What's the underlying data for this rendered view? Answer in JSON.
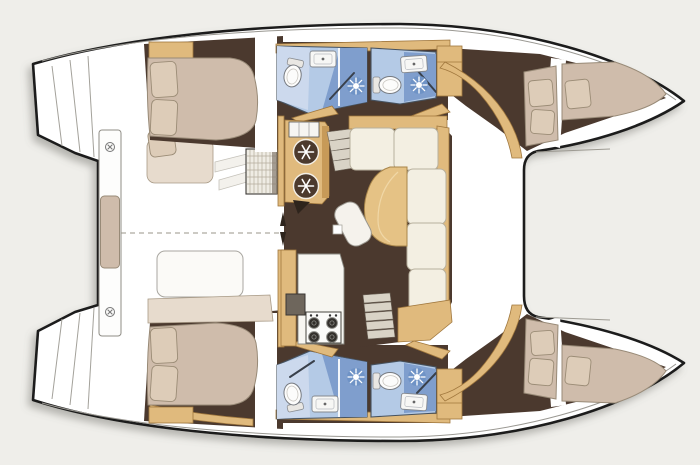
{
  "meta": {
    "title": "Catamaran interior layout plan (top view, bow to the right)",
    "diagram_type": "boat-floor-plan",
    "orientation": "bow-right"
  },
  "palette": {
    "bg": "#efeeea",
    "outline": "#1b1b1b",
    "hullFill": "#ffffff",
    "floorDark": "#4b392e",
    "wood": "#e0ba7d",
    "woodEdge": "#a0773d",
    "counter": "#f7f6f1",
    "bed": "#cfbcab",
    "bedLight": "#e7dbcd",
    "pillow": "#ddccb8",
    "cream": "#f3efe2",
    "tread": "#d9d3c6",
    "bathFloor": "#b4cae6",
    "bathLight": "#ccd9ed",
    "bathShower": "#7f9ecd",
    "bathEdge": "#46525f",
    "tableWood": "#e5c285"
  },
  "vessel": {
    "type": "sailing-catamaran",
    "cockpit": {
      "features": [
        "aft-bench-with-cushion",
        "port-bench-with-pillow",
        "starboard-bench",
        "teak-table",
        "entry-steps",
        "centerline-dashed",
        "deck-cleats"
      ]
    },
    "saloon": {
      "galley": {
        "stove_burners": 4,
        "sink": 1,
        "fridge_circles": 2,
        "cabinets": "wood"
      },
      "dinette": {
        "shape": "L-sofa",
        "cushions": 5,
        "table": "curved-wood",
        "chair": 1
      },
      "stairs_to_hulls": 2,
      "companionway_arrows": 2
    },
    "port_hull": {
      "aft_cabin": {
        "double_berth": true,
        "pillows": 2,
        "wardrobe": true,
        "bench": true
      },
      "bathrooms": [
        {
          "fixtures": [
            "toilet",
            "sink",
            "shower-head"
          ]
        },
        {
          "fixtures": [
            "toilet",
            "sink",
            "shower-head"
          ]
        }
      ],
      "forward_cabin": {
        "berths": 2,
        "pillows": 3
      }
    },
    "starboard_hull": {
      "aft_cabin": {
        "double_berth": true,
        "pillows": 2,
        "wardrobe": true,
        "bench": true
      },
      "bathrooms": [
        {
          "fixtures": [
            "toilet",
            "sink",
            "shower-head"
          ]
        },
        {
          "fixtures": [
            "toilet",
            "sink",
            "shower-head"
          ]
        }
      ],
      "forward_cabin": {
        "berths": 2,
        "pillows": 3
      }
    },
    "foredeck": {
      "crossbeam": true,
      "platform_between_bows": true
    },
    "transoms": {
      "port_steps": true,
      "starboard_steps": true
    }
  }
}
